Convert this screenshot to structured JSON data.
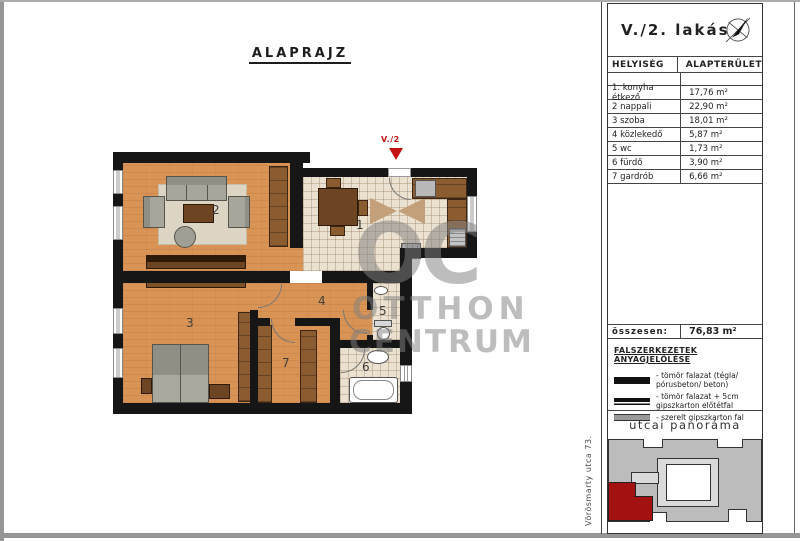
{
  "page": {
    "drawing_title": "ALAPRAJZ"
  },
  "title_block": {
    "unit_title": "V./2. lakás",
    "table": {
      "col_room": "HELYISÉG",
      "col_area": "ALAPTERÜLET",
      "rows": [
        {
          "name": "1. konyha étkező",
          "area": "17,76 m²"
        },
        {
          "name": "2  nappali",
          "area": "22,90 m²"
        },
        {
          "name": "3  szoba",
          "area": "18,01 m²"
        },
        {
          "name": "4  közlekedő",
          "area": "5,87 m²"
        },
        {
          "name": "5  wc",
          "area": "1,73 m²"
        },
        {
          "name": "6  fürdő",
          "area": "3,90 m²"
        },
        {
          "name": "7  gardrób",
          "area": "6,66 m²"
        }
      ],
      "total_label": "összesen:",
      "total_area": "76,83 m²"
    },
    "legend": {
      "title": "FALSZERKEZETEK ANYAGJELÖLÉSE",
      "items": [
        {
          "swatch": "solid-black-wall",
          "label": "- tömör falazat (tégla/ pórusbeton/ beton)"
        },
        {
          "swatch": "black-lined-wall",
          "label": "- tömör falazat + 5cm gipszkarton előtétfal"
        },
        {
          "swatch": "gray-drywall",
          "label": "- szerelt gipszkarton fal"
        }
      ]
    },
    "panorama_title": "utcai panoráma"
  },
  "plan": {
    "entrance_label": "V./2",
    "room_numbers": [
      "1",
      "2",
      "3",
      "4",
      "5",
      "6",
      "7"
    ],
    "watermark": {
      "monogram": "OC",
      "line1": "OTTHON",
      "line2": "CENTRUM"
    }
  },
  "street_label": "Vörösmarty utca 73.",
  "colors": {
    "wall_black": "#161616",
    "wood_floor": "#d89355",
    "tile_floor": "#eae1d0",
    "entrance_marker_red": "#c41111",
    "site_unit_red": "#a31111",
    "site_building_gray": "#bcbcbc"
  }
}
